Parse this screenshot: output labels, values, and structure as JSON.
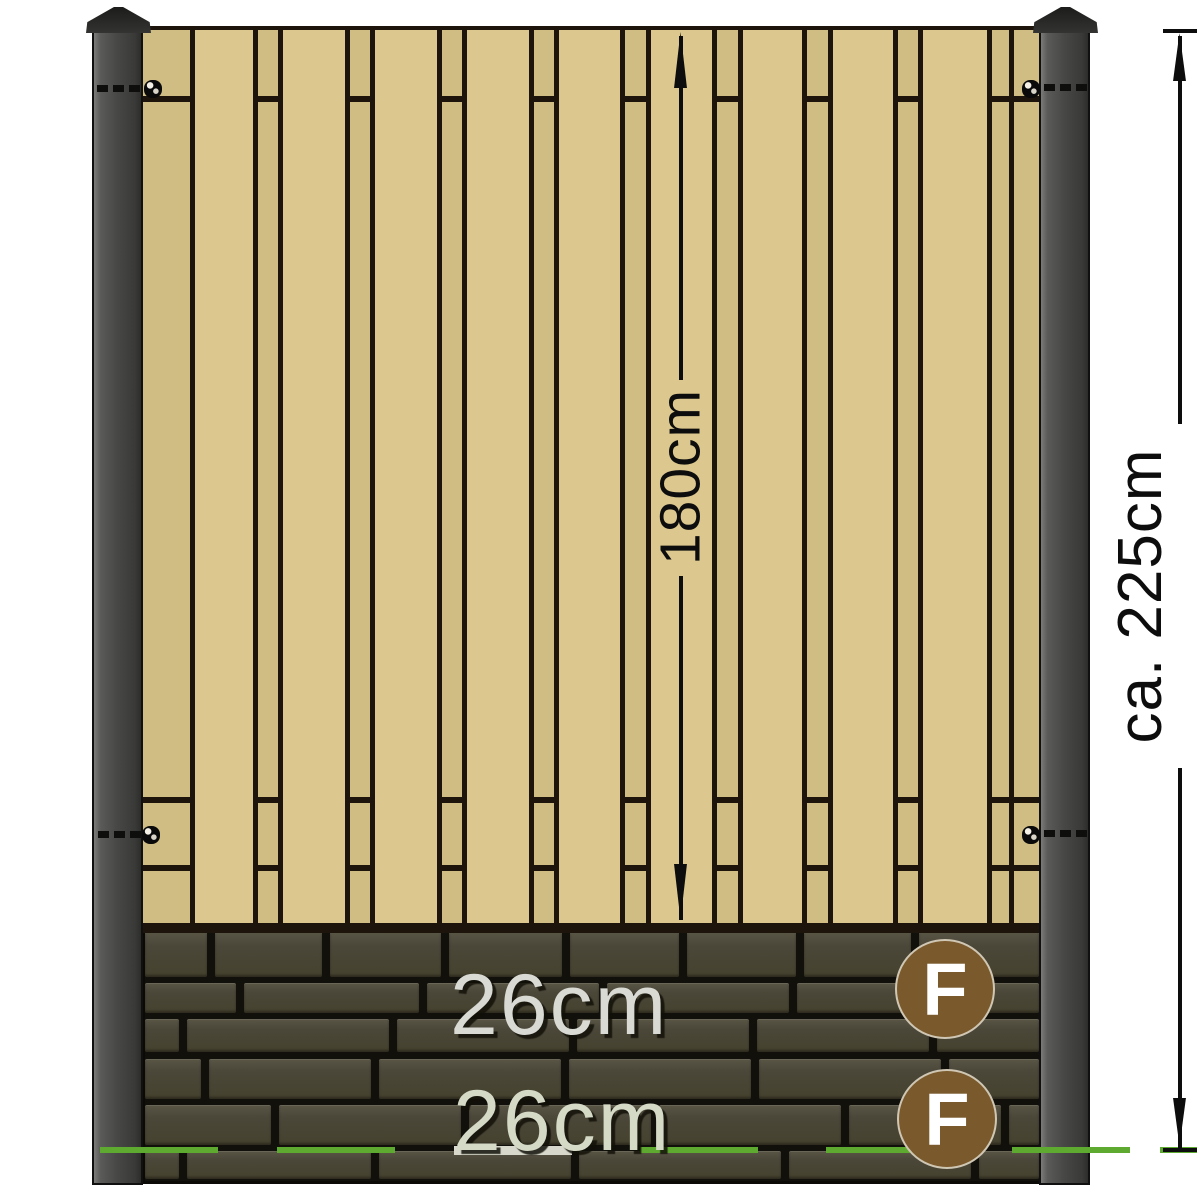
{
  "dimensions": {
    "panel_height": "180cm",
    "total_height": "ca. 225cm",
    "plate1_height": "26cm",
    "plate2_height": "26cm"
  },
  "badges": [
    {
      "letter": "F"
    },
    {
      "letter": "F"
    }
  ],
  "icons": {
    "post_cap": "post-cap-icon",
    "screw": "screw-icon",
    "arrow_up": "arrow-up-icon",
    "arrow_down": "arrow-down-icon"
  },
  "colors": {
    "wood_front": "#dcc88e",
    "wood_back": "#d0bd84",
    "outline": "#1d150b",
    "post_dark": "#393937",
    "post_light": "#7b7b79",
    "plate_face": "#4b4739",
    "plate_joint": "#12100a",
    "ground_line_green": "#5ea92f",
    "badge_brown": "#7a5a2c",
    "label_light": "#dadad4",
    "dimension_text": "#0d0d0d"
  }
}
